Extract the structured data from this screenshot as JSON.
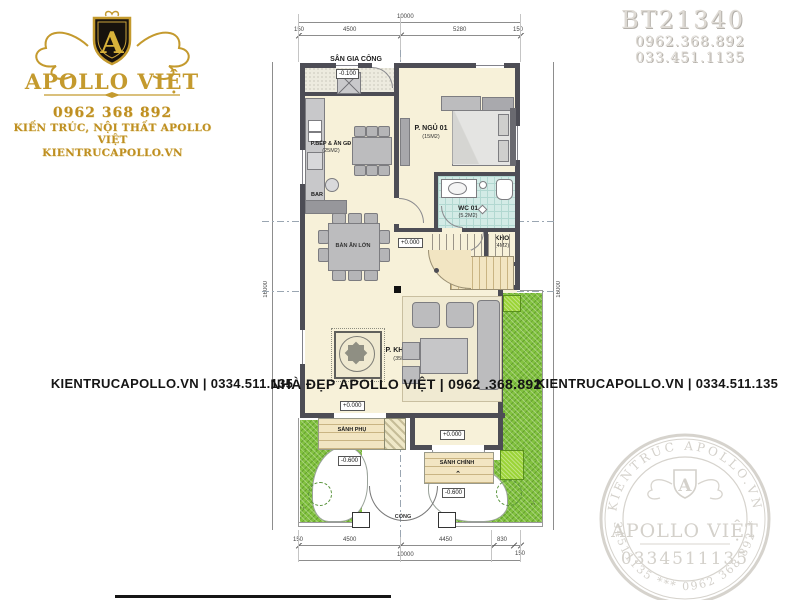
{
  "colors": {
    "gold": "#bf8f22",
    "wall": "#4d4d55",
    "floor_cream": "#f7f1d9",
    "grass_green": "#82c240",
    "tile_teal": "#d3ebe6",
    "stamp_gray": "#d6d3cd",
    "watermark_text": "#151515"
  },
  "logo": {
    "monogram": "A",
    "brand": "APOLLO VIỆT",
    "phone": "0962 368 892",
    "tagline": "KIẾN TRÚC, NỘI THẤT APOLLO VIỆT",
    "website": "KIENTRUCAPOLLO.VN"
  },
  "project": {
    "code": "BT21340",
    "phone_1": "0962.368.892",
    "phone_2": "033.451.1135"
  },
  "watermarks": {
    "left": "KIENTRUCAPOLLO.VN | 0334.511.135",
    "center": "NHÀ ĐẸP APOLLO VIỆT | 0962 .368.892",
    "right": "KIENTRUCAPOLLO.VN | 0334.511.135"
  },
  "stamp": {
    "ring_top": "KIENTRUC APOLLO.VN",
    "ring_bottom": "0334511135 *** 0962 368 892 ***",
    "monogram": "A",
    "brand": "APOLLO VIỆT",
    "phone": "0334511135"
  },
  "plan": {
    "rooms": {
      "san_gia_cong": "SÂN GIA CÔNG",
      "bep": "P.BẾP & ĂN GĐ",
      "bep_area": "(25M2)",
      "bar": "BAR",
      "ngu01": "P. NGỦ 01",
      "ngu01_area": "(15M2)",
      "wc01": "WC 01",
      "wc01_area": "(5.2M2)",
      "kho": "KHO",
      "kho_area": "(4M2)",
      "ban_an_lon": "BÀN ĂN LỚN",
      "khach": "P. KHÁCH",
      "khach_area": "(35M2)",
      "sanh_phu": "SẢNH PHỤ",
      "sanh_chinh": "SẢNH CHÍNH",
      "cong": "CỔNG"
    },
    "levels": {
      "ground": "+0.000",
      "minus_600": "-0.600",
      "minus_100": "-0.100"
    },
    "dims": {
      "top_total": "10000",
      "top_pad_left": "150",
      "top_seg_1": "4500",
      "top_seg_2": "5280",
      "top_pad_right": "150",
      "bottom_total": "10000",
      "bottom_pad_left": "150",
      "bottom_seg_1": "4500",
      "bottom_seg_2": "4450",
      "bottom_seg_3": "830",
      "bottom_pad_right": "150",
      "side_left": "16000",
      "side_right": "16000"
    }
  }
}
